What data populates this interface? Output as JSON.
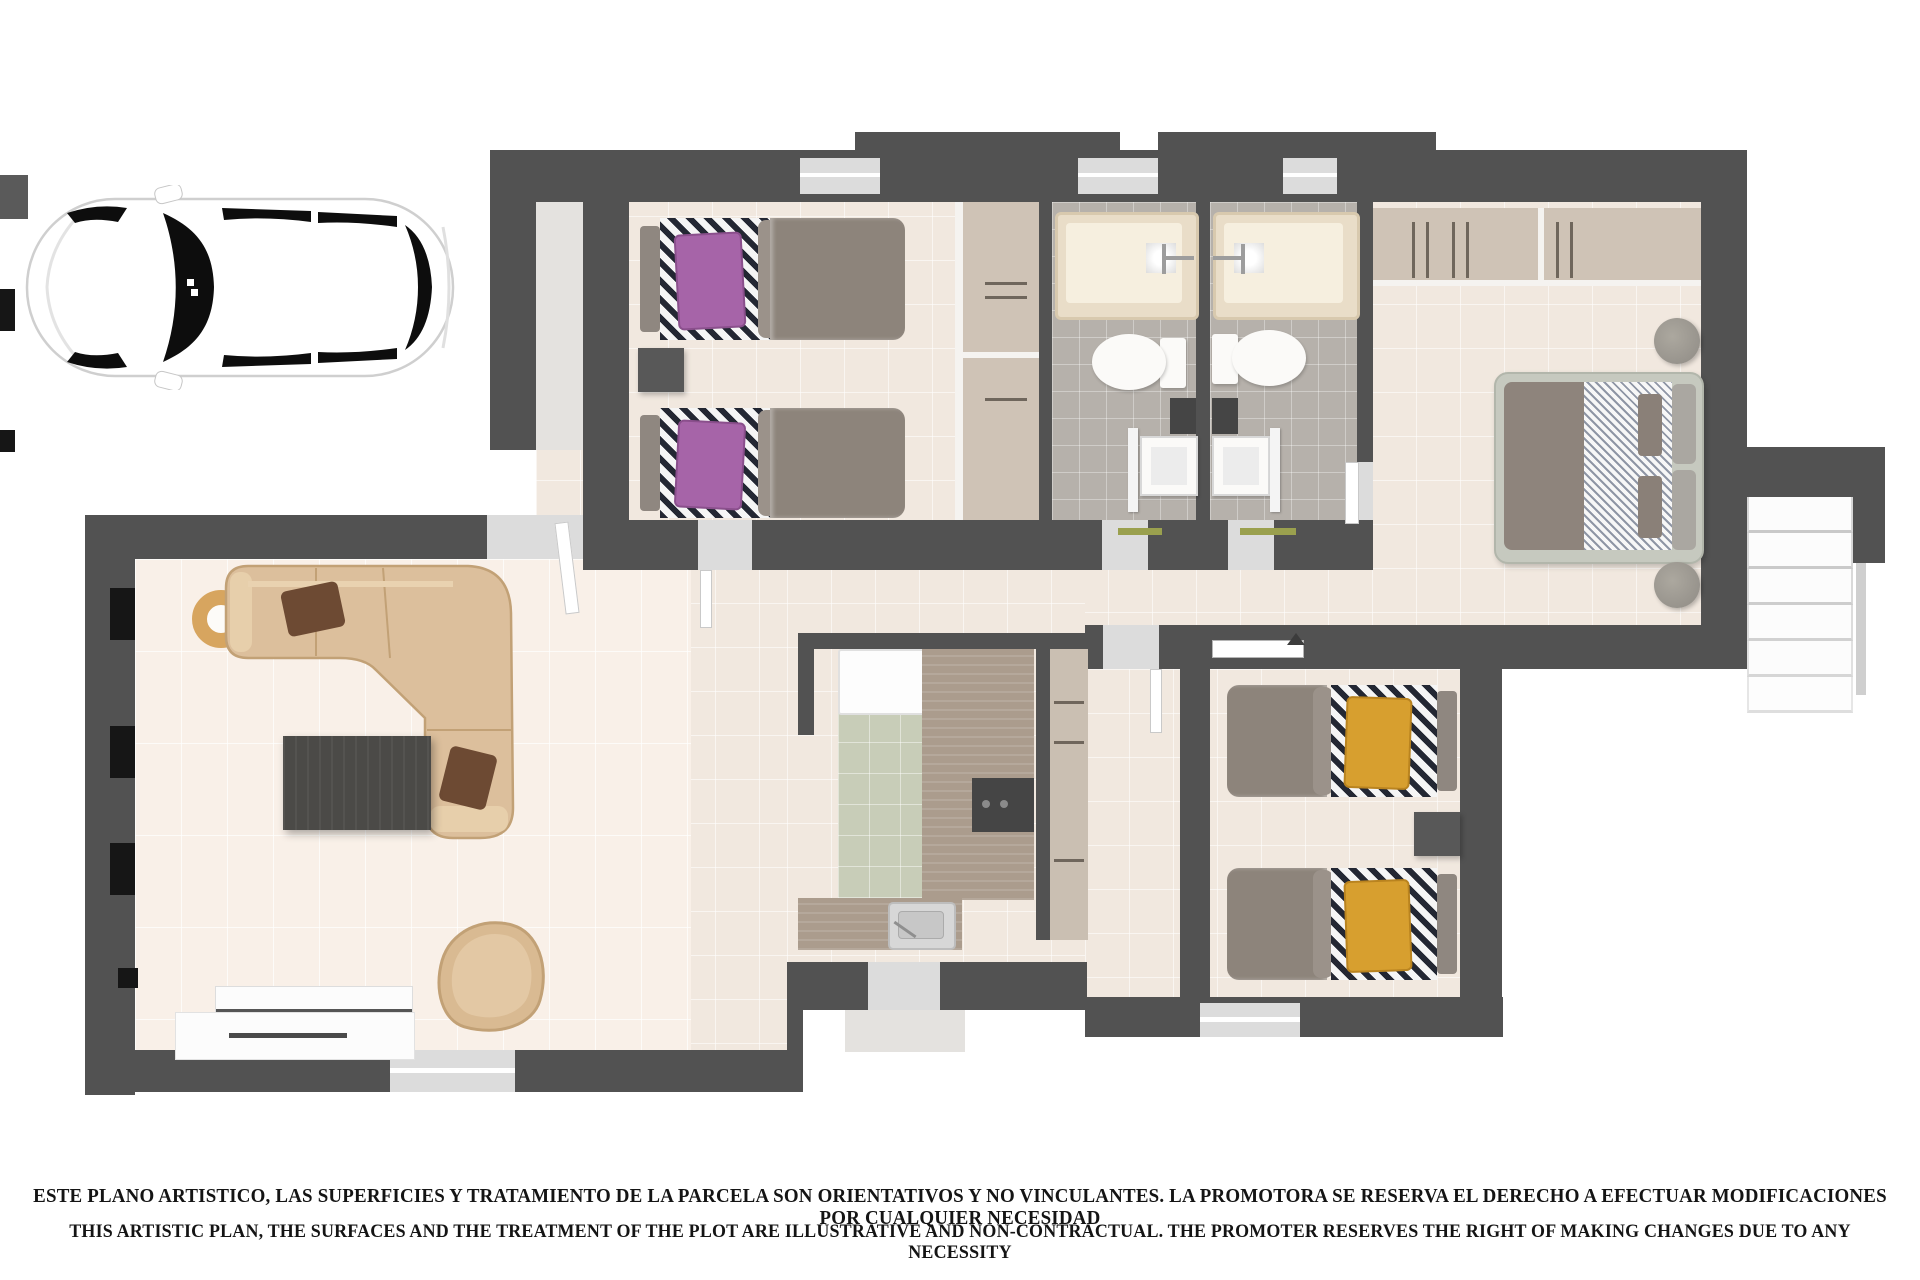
{
  "meta": {
    "title": "Artistic 3D top-down floor plan render with parked car and legal disclaimer"
  },
  "disclaimer": {
    "line_es": "ESTE PLANO ARTISTICO, LAS SUPERFICIES Y TRATAMIENTO DE LA PARCELA SON ORIENTATIVOS Y NO VINCULANTES. LA PROMOTORA SE RESERVA EL DERECHO A EFECTUAR MODIFICACIONES POR CUALQUIER NECESIDAD",
    "line_en": "THIS ARTISTIC PLAN, THE SURFACES AND THE TREATMENT OF THE PLOT ARE ILLUSTRATIVE AND NON-CONTRACTUAL. THE PROMOTER RESERVES THE RIGHT OF MAKING CHANGES DUE TO ANY NECESSITY"
  },
  "car": {
    "id": "car-top-view",
    "body_color": "#ffffff",
    "glass_color": "#0d0d0d",
    "facing": "left"
  },
  "palette": {
    "wall": "#525252",
    "floor_beige": "#f1e8df",
    "floor_living": "#f9f0e8",
    "floor_bathroom": "#b6b1ab",
    "floor_kitchen": "#c8cdb8",
    "wood_counter": "#ab9c8d",
    "closet": "#cfc3b6",
    "sofa_tan": "#dcbe9a",
    "throw_pillow_brown": "#6d4a33",
    "pillow_purple": "#a664a8",
    "pillow_orange": "#d79f2f",
    "duvet_grey": "#8d847b",
    "coffee_table": "#4b4a47",
    "towel_green": "#9aa04e",
    "stair_tread": "#fcfcfc"
  },
  "plan": {
    "rooms": [
      {
        "id": "bedroom-twin-purple",
        "features": [
          "two single beds with purple pillows and striped linen",
          "nightstand",
          "built-in wardrobe"
        ]
      },
      {
        "id": "bathroom-1",
        "features": [
          "bathtub",
          "toilet",
          "washbasin",
          "green towel bar",
          "window"
        ]
      },
      {
        "id": "bathroom-2",
        "features": [
          "bathtub",
          "toilet",
          "washbasin",
          "green towel bar",
          "window"
        ]
      },
      {
        "id": "master-bedroom",
        "features": [
          "open closet with hanging rails",
          "double bed with hatched linen",
          "two round bedside tables"
        ]
      },
      {
        "id": "bedroom-twin-orange",
        "features": [
          "two single beds with orange pillows and striped linen",
          "nightstand",
          "wall shelf"
        ]
      },
      {
        "id": "kitchen",
        "features": [
          "fridge",
          "L-shaped wood counter",
          "cooktop",
          "sink",
          "green tiled floor",
          "tall cabinet column"
        ]
      },
      {
        "id": "living-dining-room",
        "features": [
          "L-shaped tan sofa with brown pillows",
          "dark coffee table",
          "round rug ring",
          "lounge chair",
          "white TV sideboard"
        ]
      },
      {
        "id": "hallway",
        "features": [
          "corridor connecting rooms"
        ]
      },
      {
        "id": "entry-porch",
        "features": [
          "front door"
        ]
      },
      {
        "id": "staircase",
        "features": [
          "six white exterior steps"
        ]
      }
    ]
  }
}
